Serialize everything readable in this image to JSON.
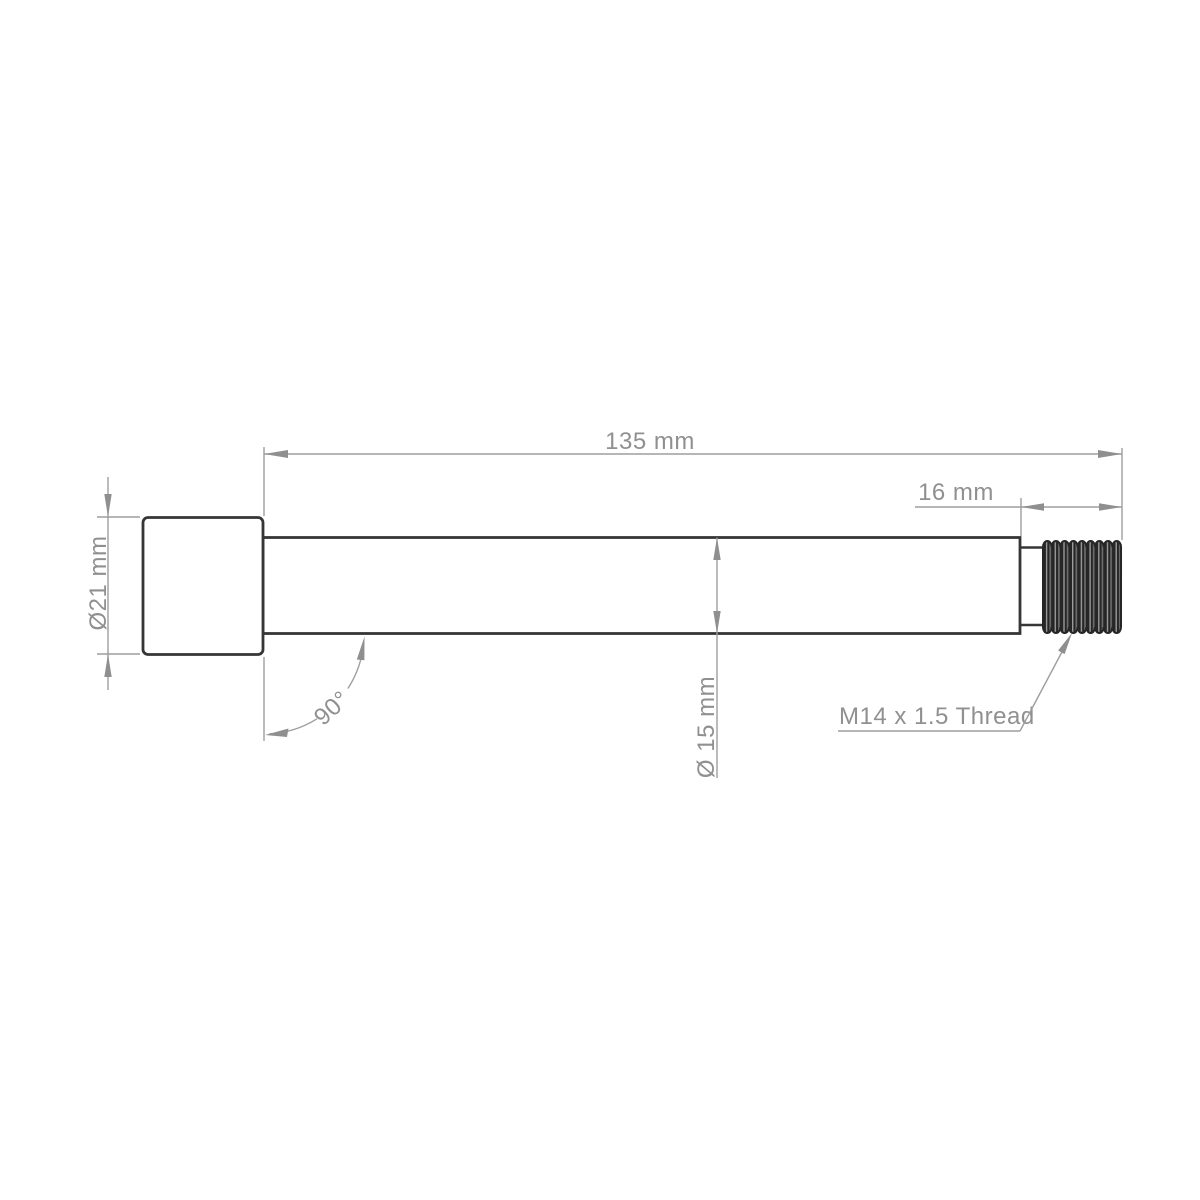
{
  "drawing": {
    "type": "engineering-dimension-drawing",
    "subject": "thru-axle side view",
    "background": "#ffffff",
    "colors": {
      "part_outline": "#363636",
      "dimension_lines": "#9e9e9e",
      "label_text": "#909090",
      "thread_fill_dark": "#262626",
      "thread_fill_light": "#9a9a9a"
    },
    "labels": {
      "overall_length": "135 mm",
      "thread_length": "16 mm",
      "head_diameter": "Ø21 mm",
      "shaft_diameter": "Ø 15 mm",
      "head_angle": "90°",
      "thread_spec": "M14 x 1.5 Thread"
    }
  }
}
